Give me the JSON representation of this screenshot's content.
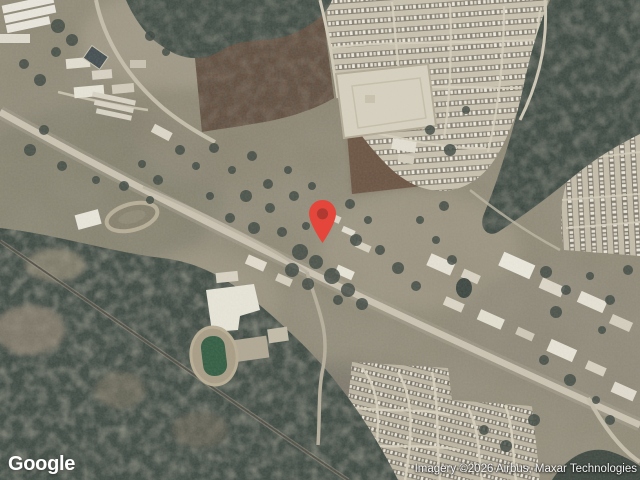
{
  "map": {
    "provider_logo": "Google",
    "attribution": "Imagery ©2026 Airbus, Maxar Technologies",
    "marker": {
      "icon": "location-pin-icon",
      "color": "#E5463B",
      "inner_color": "#A73830"
    },
    "colors": {
      "terrain_base": "#8E8876",
      "woodland": "#39443E",
      "field_brown": "#5D4A3B",
      "road": "#C9C2B1",
      "railroad": "#4E4C44",
      "sports_field": "#2F5B41",
      "building_light": "#E7E3D6",
      "logo_text": "#FFFFFF",
      "attribution_text": "#F5F5F5"
    }
  }
}
